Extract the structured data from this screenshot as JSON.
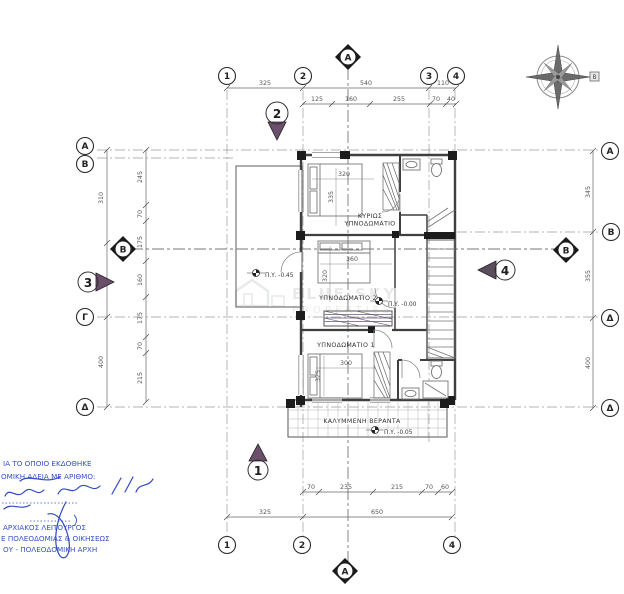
{
  "drawing": {
    "type_note": "floor plan",
    "watermark": {
      "line1": "BLUE SKY",
      "line2": "PROPERTIES"
    }
  },
  "compass": {
    "label": "Β"
  },
  "grid": {
    "top": [
      "1",
      "2",
      "3",
      "4"
    ],
    "bottom": [
      "1",
      "2",
      "4"
    ],
    "left": [
      "Α",
      "Β",
      "Γ",
      "Δ"
    ],
    "right": [
      "Α",
      "Β",
      "Δ",
      "Δ"
    ]
  },
  "sections": {
    "a": "Α",
    "b": "Β"
  },
  "view_markers": {
    "m1": "1",
    "m2": "2",
    "m3": "3",
    "m4": "4"
  },
  "dimensions": {
    "top_row1": [
      "325",
      "540",
      "110"
    ],
    "top_row2": [
      "125",
      "160",
      "255",
      "70",
      "40"
    ],
    "bottom_row1": [
      "70",
      "235",
      "215",
      "70",
      "60"
    ],
    "bottom_row2": [
      "325",
      "650"
    ],
    "left_outer": [
      "310",
      "365",
      "400"
    ],
    "left_inner": [
      "245",
      "70",
      "175",
      "160",
      "175",
      "70",
      "215"
    ],
    "right_side": [
      "345",
      "355",
      "400"
    ]
  },
  "rooms": {
    "master": {
      "line1": "ΚΥΡΙΩΣ",
      "line2": "ΥΠΝΟΔΩΜΑΤΙΟ",
      "dim_w": "320",
      "dim_h": "335"
    },
    "bed2": {
      "label": "ΥΠΝΟΔΩΜΑΤΙΟ 2",
      "dim_w": "360",
      "dim_h": "320"
    },
    "bed1": {
      "label": "ΥΠΝΟΔΩΜΑΤΙΟ 1",
      "dim_w": "300",
      "dim_h": "325"
    },
    "veranda": {
      "label": "ΚΑΛΥΜΜΕΝΗ ΒΕΡΑΝΤΑ"
    }
  },
  "levels": {
    "terrace": "Π.Υ. -0.45",
    "floor": "Π.Υ. -0.00",
    "veranda": "Π.Υ. -0.05"
  },
  "stamp": {
    "line1": "ΙΑ ΤΟ ΟΠΟΙΟ ΕΚΔΟΘΗΚΕ",
    "line2": "ΟΜΙΚΗ ΑΔΕΙΑ ΜΕ ΑΡΙΘΜΟ:",
    "line3": "ΑΡΧΙΑΚΟΣ ΛΕΙΤΟΥΡΓΟΣ",
    "line4": "Ε ΠΟΛΕΟΔΟΜΙΑΣ & ΟΙΚΗΣΕΩΣ",
    "line5": "ΟΥ - ΠΟΛΕΟΔΟΜΙΚΗ ΑΡΧΗ"
  },
  "colors": {
    "stamp_blue": "#3550c5",
    "marker_fill": "#6b4f6b",
    "wall": "#3f3f3f"
  }
}
